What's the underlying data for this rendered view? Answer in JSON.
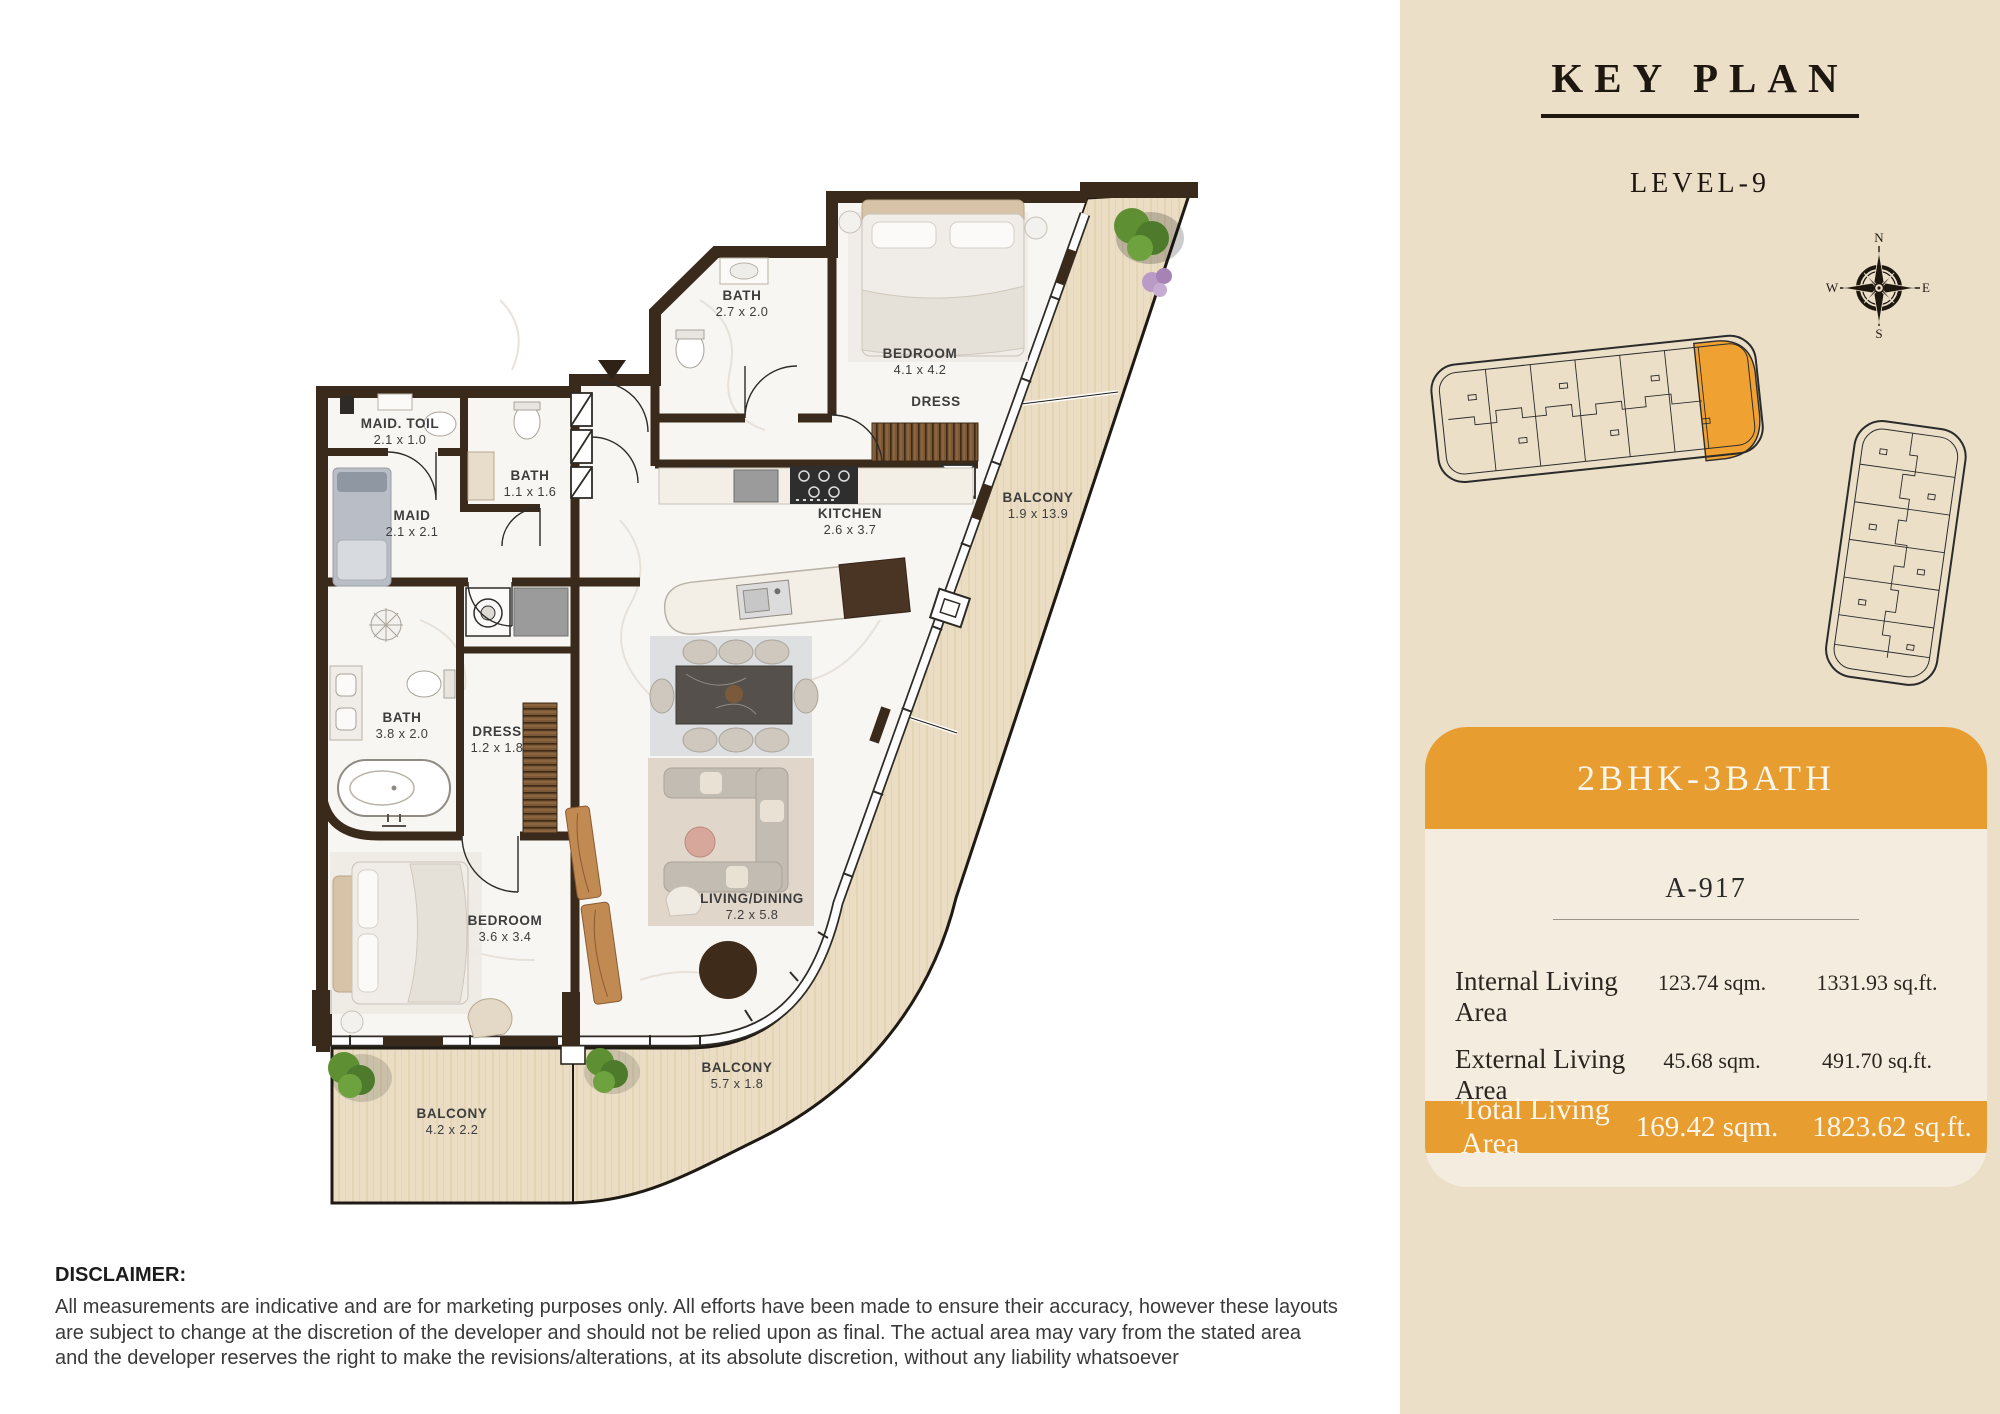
{
  "panel": {
    "title": "KEY PLAN",
    "level": "LEVEL-9",
    "compass": {
      "n": "N",
      "e": "E",
      "s": "S",
      "w": "W"
    }
  },
  "card": {
    "type_label": "2BHK-3BATH",
    "unit_number": "A-917",
    "rows": [
      {
        "label": "Internal Living Area",
        "sqm": "123.74 sqm.",
        "sqft": "1331.93 sq.ft."
      },
      {
        "label": "External Living Area",
        "sqm": "45.68 sqm.",
        "sqft": "491.70 sq.ft."
      }
    ],
    "total": {
      "label": "Total Living Area",
      "sqm": "169.42 sqm.",
      "sqft": "1823.62 sq.ft."
    }
  },
  "floor_plan": {
    "highlighted_unit": "A-917",
    "rooms": [
      {
        "name": "BATH",
        "dims": "2.7 x 2.0",
        "x": 742,
        "y": 300
      },
      {
        "name": "BEDROOM",
        "dims": "4.1 x 4.2",
        "x": 920,
        "y": 358
      },
      {
        "name": "DRESS",
        "dims": "",
        "x": 936,
        "y": 406
      },
      {
        "name": "MAID. TOIL",
        "dims": "2.1 x 1.0",
        "x": 400,
        "y": 428
      },
      {
        "name": "BATH",
        "dims": "1.1 x 1.6",
        "x": 530,
        "y": 480
      },
      {
        "name": "MAID",
        "dims": "2.1 x 2.1",
        "x": 412,
        "y": 520
      },
      {
        "name": "KITCHEN",
        "dims": "2.6 x 3.7",
        "x": 850,
        "y": 518
      },
      {
        "name": "BALCONY",
        "dims": "1.9 x 13.9",
        "x": 1038,
        "y": 502
      },
      {
        "name": "BATH",
        "dims": "3.8 x 2.0",
        "x": 402,
        "y": 722
      },
      {
        "name": "DRESS",
        "dims": "1.2 x 1.8",
        "x": 497,
        "y": 736
      },
      {
        "name": "BEDROOM",
        "dims": "3.6 x 3.4",
        "x": 505,
        "y": 925
      },
      {
        "name": "LIVING/DINING",
        "dims": "7.2 x 5.8",
        "x": 752,
        "y": 903
      },
      {
        "name": "BALCONY",
        "dims": "5.7 x 1.8",
        "x": 737,
        "y": 1072
      },
      {
        "name": "BALCONY",
        "dims": "4.2 x 2.2",
        "x": 452,
        "y": 1118
      }
    ]
  },
  "disclaimer": {
    "heading": "DISCLAIMER:",
    "body_lines": [
      "All measurements are indicative and are for marketing purposes only. All efforts have been made to ensure their accuracy, however these layouts",
      "are subject to change at the discretion of the developer and should not be relied upon as final. The actual area may vary from the stated area",
      "and the developer reserves the right to make the revisions/alterations, at its absolute discretion, without any liability whatsoever"
    ]
  },
  "colors": {
    "accent_orange": "#E89D31",
    "panel_bg": "#EBDFC8",
    "card_bg": "#F4EDDF",
    "wall_brown": "#3A2A1B",
    "balcony_wood": "#EADDC3",
    "floor_white": "#F8F6F2",
    "title_ink": "#1E1710",
    "label_gray": "#3D3D3D"
  }
}
